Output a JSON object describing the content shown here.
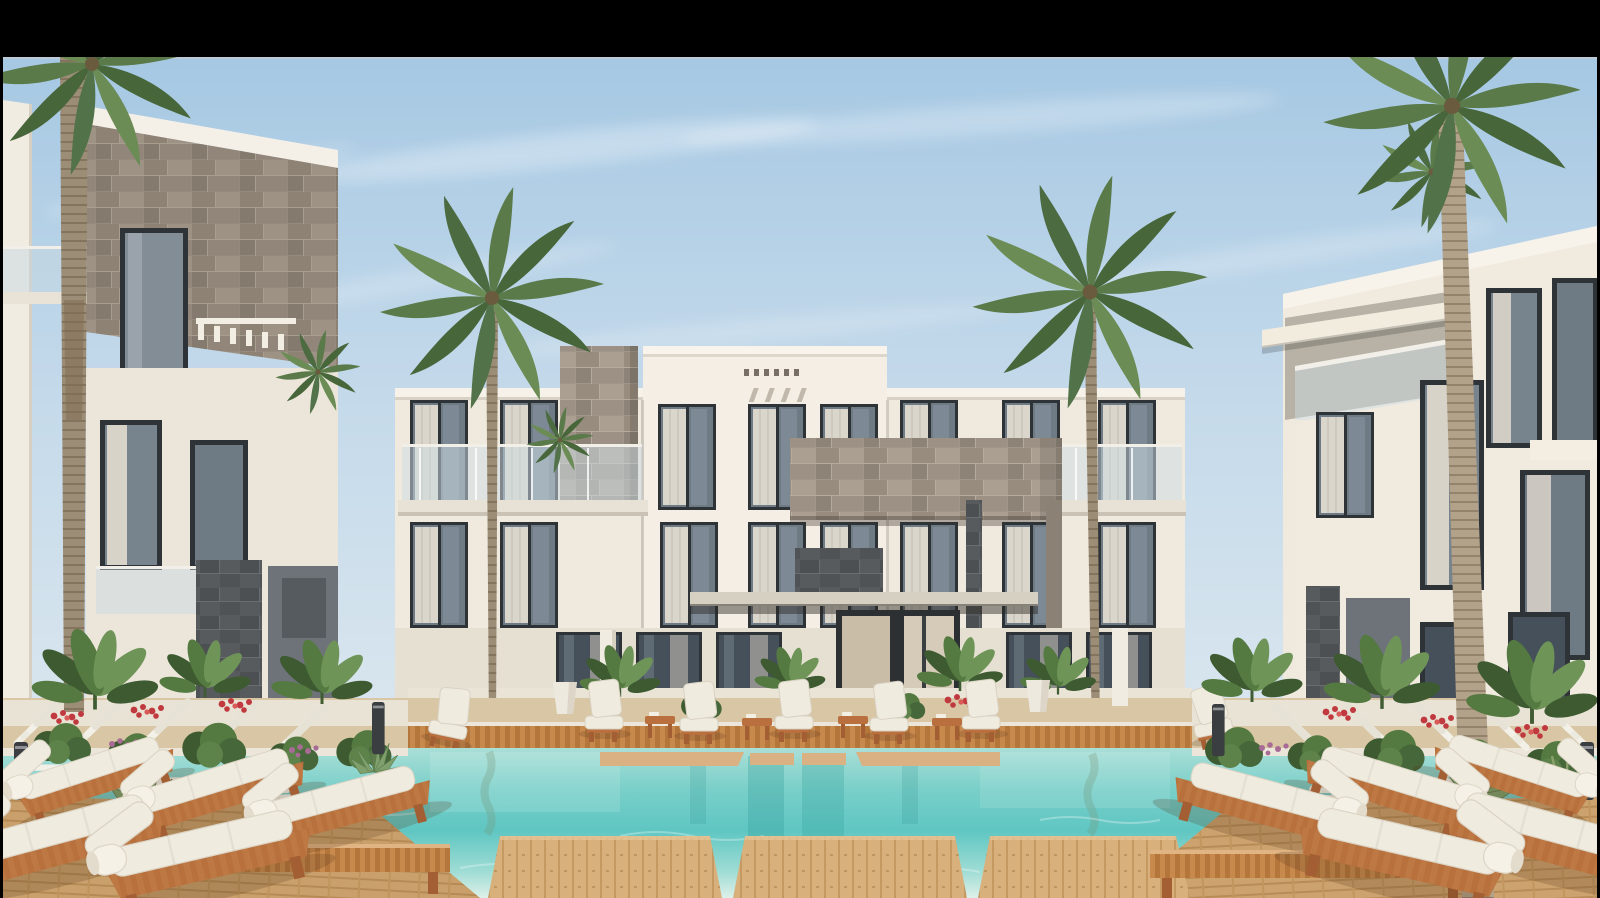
{
  "meta": {
    "type": "architectural-rendering",
    "subject": "Modern three-storey resort apartment complex with central courtyard swimming pool",
    "time_of_day": "daytime",
    "sky": "clear light blue with wispy clouds"
  },
  "letterbox": {
    "color": "#000000",
    "top_bar_height_px": 57,
    "side_margin_px": 3
  },
  "palette": {
    "letterbox_black": "#000000",
    "sky_top": "#a6c8e3",
    "sky_mid": "#c3d9ea",
    "sky_horizon": "#dde8ef",
    "cloud_white": "#ffffff",
    "building_white": "#efe9de",
    "building_bright": "#f4eee4",
    "building_shade": "#d9d3c7",
    "ground_base": "#d8c6a4",
    "stone_light_base": "#a1968a",
    "stone_dark_base": "#585b5e",
    "accent_gray_panel": "#6e737a",
    "window_glass": "#6e7b85",
    "window_frame": "#2e3337",
    "curtain": "#e7e0d3",
    "entrance_glass": "#c9bda8",
    "pool_deep": "#5fc6c2",
    "pool_mid": "#79cfc9",
    "pool_shallow": "#a9dfd7",
    "pool_foam": "#ddf0e9",
    "coping_light": "#ece6da",
    "deck_wood": "#d2a873",
    "deck_slat_wood": "#c8894d",
    "furniture_wood": "#b96f3e",
    "cushion_white": "#f0ebdf",
    "pool_lounger_white": "#f3f0e8",
    "planter_wall": "#eae4d7",
    "foliage_dark": "#3d5a31",
    "foliage_mid": "#547a41",
    "foliage_light": "#6f9458",
    "flower_red": "#c0393f",
    "flower_pink": "#a86b95",
    "palm_trunk": "#9c8d77",
    "palm_trunk_right": "#b3a28a",
    "palm_frond_dark": "#47663a",
    "palm_frond_mid": "#5a7a49",
    "palm_frond_light": "#6b8c55",
    "bollard_dark": "#3b3e41"
  },
  "scene": {
    "counts": {
      "tall_palm_trees": 4,
      "daybeds_left_cluster": 5,
      "daybeds_right_cluster": 5,
      "in_pool_loungers_left": 5,
      "in_pool_loungers_right": 5,
      "poolside_chairs_back_row": 5,
      "side_tables_back_row": 4,
      "foreground_stepping_platforms": 3,
      "building_floors": 3
    },
    "elements": [
      {
        "name": "letterbox-top-bar",
        "description": "solid black bar across the top of the frame"
      },
      {
        "name": "sky",
        "description": "light blue sky with thin wispy white clouds"
      },
      {
        "name": "central-building",
        "description": "white three-storey facade with taller central tower, glass balustrades and grey stone cladding accents"
      },
      {
        "name": "central-entrance",
        "description": "ground floor entry with canopy, dark stone header and warm glass door"
      },
      {
        "name": "left-building",
        "description": "foreground wing with stone-clad upper volume, dark windows and glass balcony"
      },
      {
        "name": "right-building",
        "description": "foreground wing with white balconies, grey accent panels and tall curtained windows"
      },
      {
        "name": "swimming-pool",
        "description": "turquoise courtyard pool with submerged ledges and reflections"
      },
      {
        "name": "wooden-deck",
        "description": "warm timber pool deck and slatted boardwalk edge"
      },
      {
        "name": "stepping-platforms",
        "description": "floating timber platforms crossing the near end of the pool"
      },
      {
        "name": "in-pool-loungers",
        "description": "white slatted recliners standing in shallow water on both sides"
      },
      {
        "name": "daybeds",
        "description": "timber daybeds with thick white mattresses and rolled bolsters"
      },
      {
        "name": "poolside-chairs",
        "description": "row of white cushioned chairs with timber side tables along the far deck"
      },
      {
        "name": "palm-trees",
        "description": "four tall palms framing the courtyard, trunks ringed, crowns of arching fronds"
      },
      {
        "name": "planting",
        "description": "banana plants, agaves and shrubs with red and pink flowers along the building bases"
      },
      {
        "name": "bollard-lights",
        "description": "short dark stone light bollards in the planting beds"
      }
    ]
  }
}
